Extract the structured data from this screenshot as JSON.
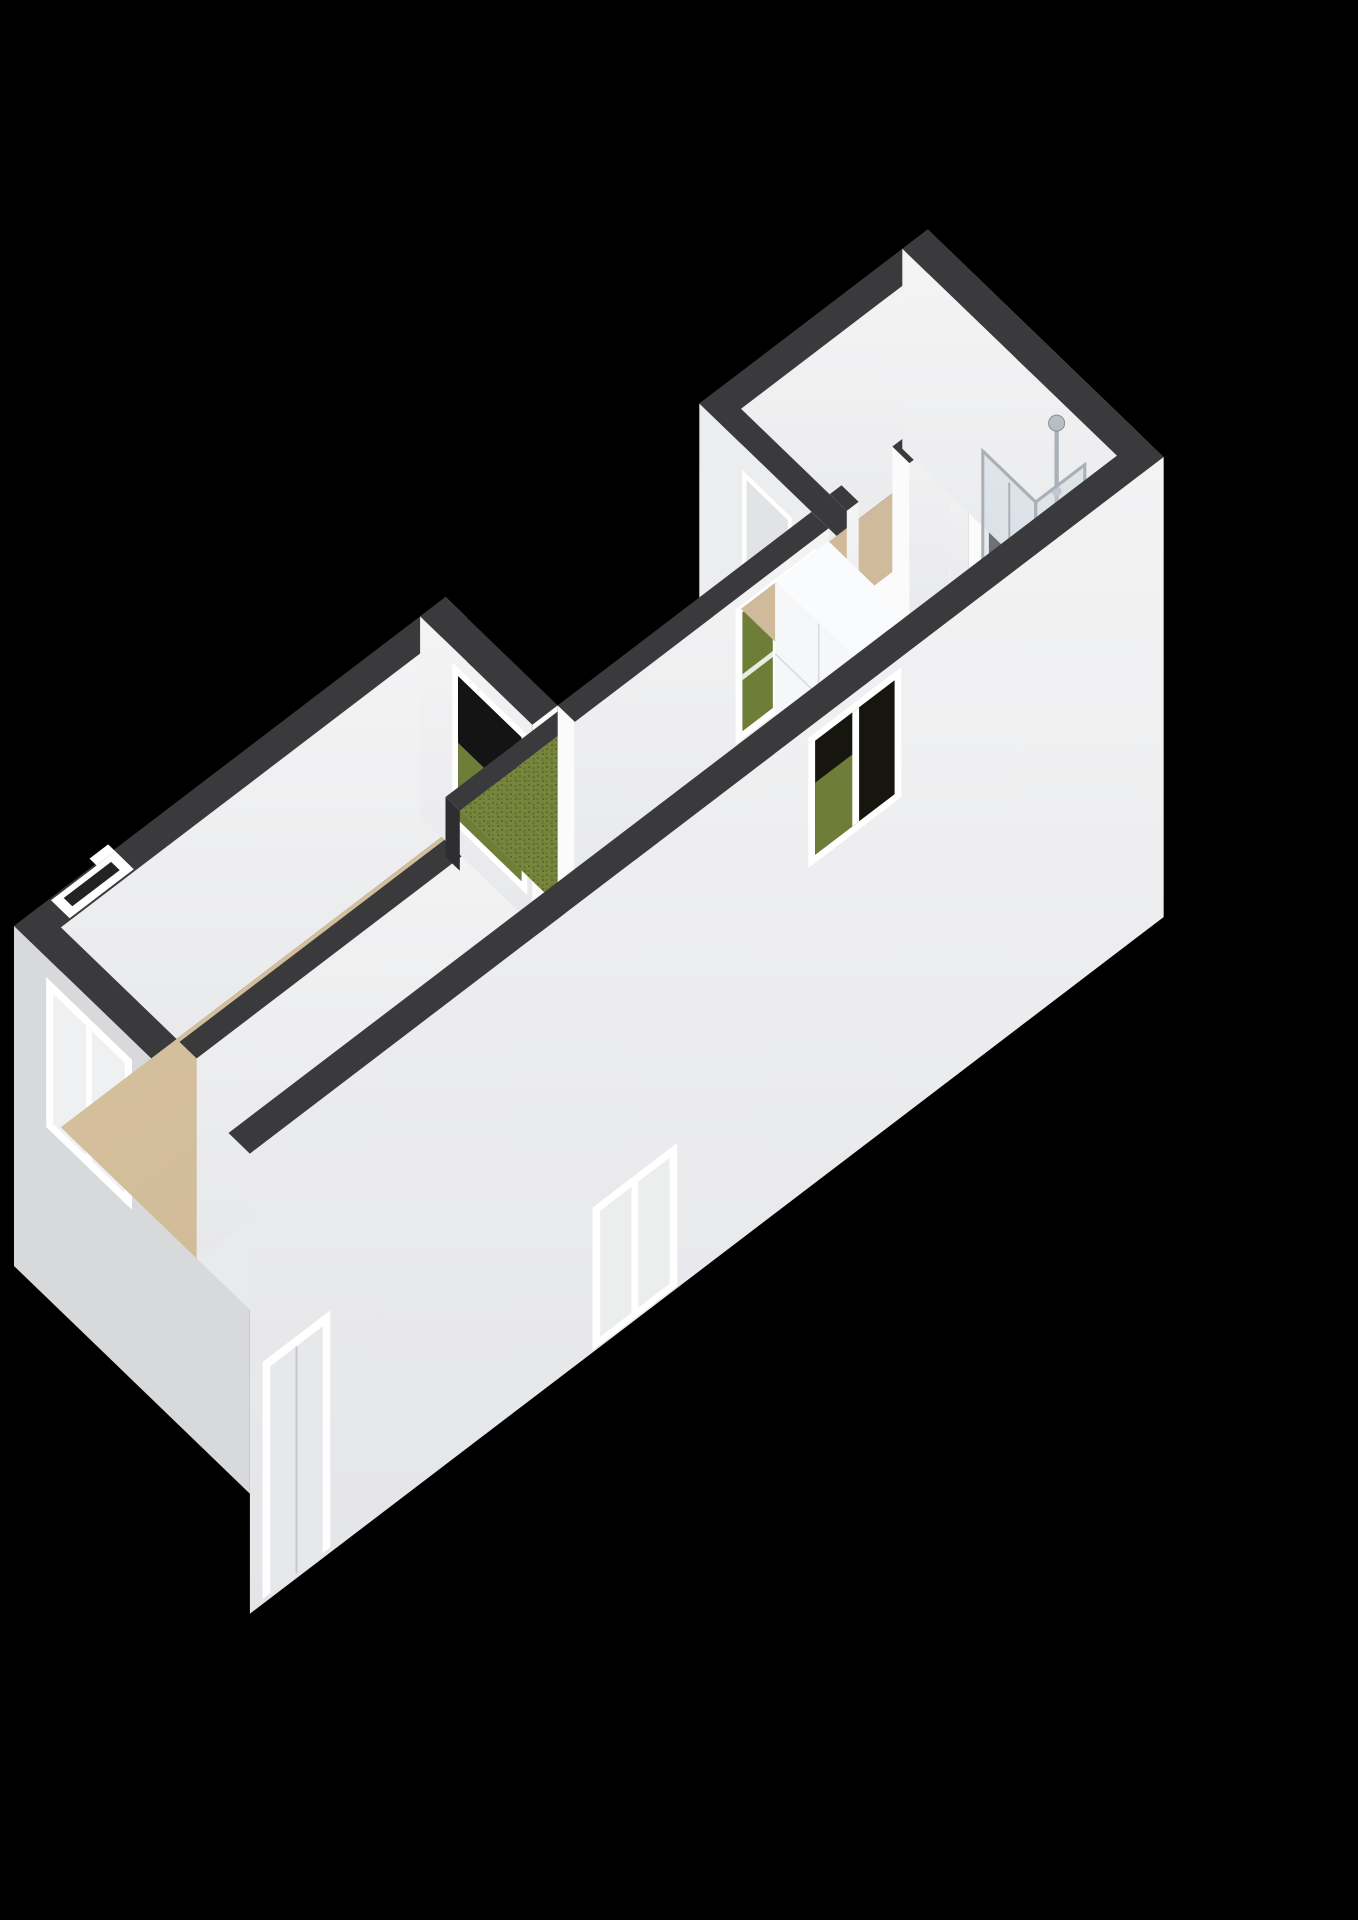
{
  "scene": {
    "kind": "3d-floorplan-render",
    "background": "#000000"
  },
  "colors": {
    "bg": "#000000",
    "wallTop": "#3a3a3c",
    "wallTopSoft": "#444446",
    "innerWall": "#f4f4f5",
    "innerWallShade": "#e7e8ea",
    "capWhite": "#fbfbfc",
    "outerWallLeft": "#d8d9db",
    "outerWallRight": "#f3f3f4",
    "outerFlank": "#eef0f2",
    "floorLiving": "#d8c3a1",
    "floorLivingDeep": "#cdb795",
    "floorBedroom": "#cfbb9c",
    "floorHall": "#d2bc9b",
    "floorBath": "#f0f1f3",
    "floorStrip": "#e9eaec",
    "floorKitchen": "#1b1b1d",
    "counterTop": "#0e0e0f",
    "hobBlack": "#0a0a0b",
    "steel": "#b9bec3",
    "steelDark": "#878e94",
    "basin": "#9aa1a7",
    "chrome": "#a9b0b7",
    "glass": "rgba(205,215,224,0.45)",
    "grass1": "#77863c",
    "grass2": "#6a7933",
    "grassDark": "#5c6a2c",
    "frame": "#ffffff",
    "doorLeaf": "#e1e3e5",
    "slot": "#232325",
    "threshold": "#2b2b2d",
    "windowGreen": "#6e7d38",
    "windowDark": "#16160f",
    "cabinet": "#f6f7f9",
    "cabinetSide": "#e9ebee",
    "seam": "#d7dadd",
    "slabEdge": "#2e2e30"
  },
  "rooms": [
    {
      "id": "living-room",
      "floor": "floorLiving"
    },
    {
      "id": "strip-room",
      "floor": "floorStrip"
    },
    {
      "id": "courtyard-garden",
      "floor": "grass"
    },
    {
      "id": "kitchen-corridor",
      "floor": "floorKitchen"
    },
    {
      "id": "bedroom",
      "floor": "floorBedroom"
    },
    {
      "id": "hall",
      "floor": "floorHall"
    },
    {
      "id": "bathroom",
      "floor": "floorBath"
    }
  ],
  "fixtures": [
    "front-door",
    "end-wall-window",
    "living-room-courtyard-window",
    "kitchen-window",
    "kitchen-counter",
    "double-sink",
    "gas-hob",
    "tall-kitchen-cabinets",
    "hall-cabinets",
    "shower-cabin",
    "shower-fixture",
    "bedroom-radiator",
    "courtyard-door",
    "corridor-door",
    "lower-level-door",
    "lower-level-window"
  ]
}
